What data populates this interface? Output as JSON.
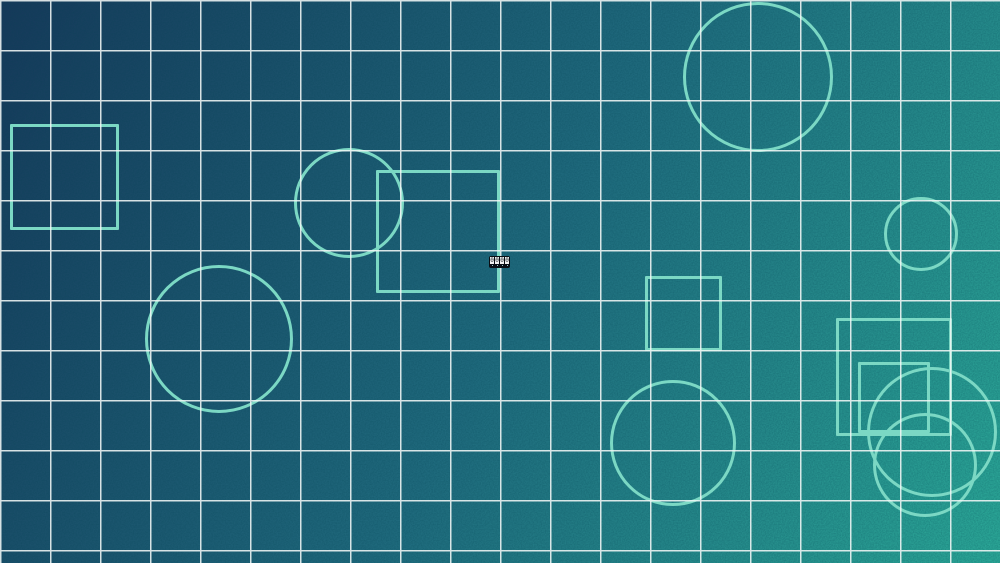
{
  "canvas": {
    "width_px": 1000,
    "height_px": 563,
    "description": "gradient canvas with grid overlay and outlined shapes"
  },
  "colors": {
    "gradient_top_left": "#16395a",
    "gradient_mid": "#1f6a7d",
    "gradient_bottom_right": "#2ba897",
    "grid_line": "#f2f7f6",
    "shape_stroke": "#7bd8c4",
    "glyph_bg": "#0a0e14",
    "glyph_box_bg": "#f2f2f2",
    "glyph_char": "#15181d",
    "glyph_dot": "#9fc4cc"
  },
  "grid": {
    "spacing_px": 50,
    "line_width_px": 1.5
  },
  "shapes": [
    {
      "type": "square",
      "x": 10,
      "y": 124,
      "w": 109,
      "h": 106
    },
    {
      "type": "circle",
      "cx": 349,
      "cy": 203,
      "r": 55
    },
    {
      "type": "square",
      "x": 376,
      "y": 170,
      "w": 124,
      "h": 123
    },
    {
      "type": "circle",
      "cx": 758,
      "cy": 77,
      "r": 75
    },
    {
      "type": "circle",
      "cx": 921,
      "cy": 234,
      "r": 37
    },
    {
      "type": "square",
      "x": 645,
      "y": 276,
      "w": 77,
      "h": 75
    },
    {
      "type": "circle",
      "cx": 219,
      "cy": 339,
      "r": 74
    },
    {
      "type": "circle",
      "cx": 673,
      "cy": 443,
      "r": 63
    },
    {
      "type": "square",
      "x": 836,
      "y": 318,
      "w": 116,
      "h": 118
    },
    {
      "type": "square",
      "x": 858,
      "y": 362,
      "w": 72,
      "h": 71
    },
    {
      "type": "circle",
      "cx": 932,
      "cy": 432,
      "r": 65
    },
    {
      "type": "circle",
      "cx": 925,
      "cy": 465,
      "r": 52
    }
  ],
  "glyph_badge": {
    "x": 489,
    "y": 256,
    "characters": "0000"
  }
}
